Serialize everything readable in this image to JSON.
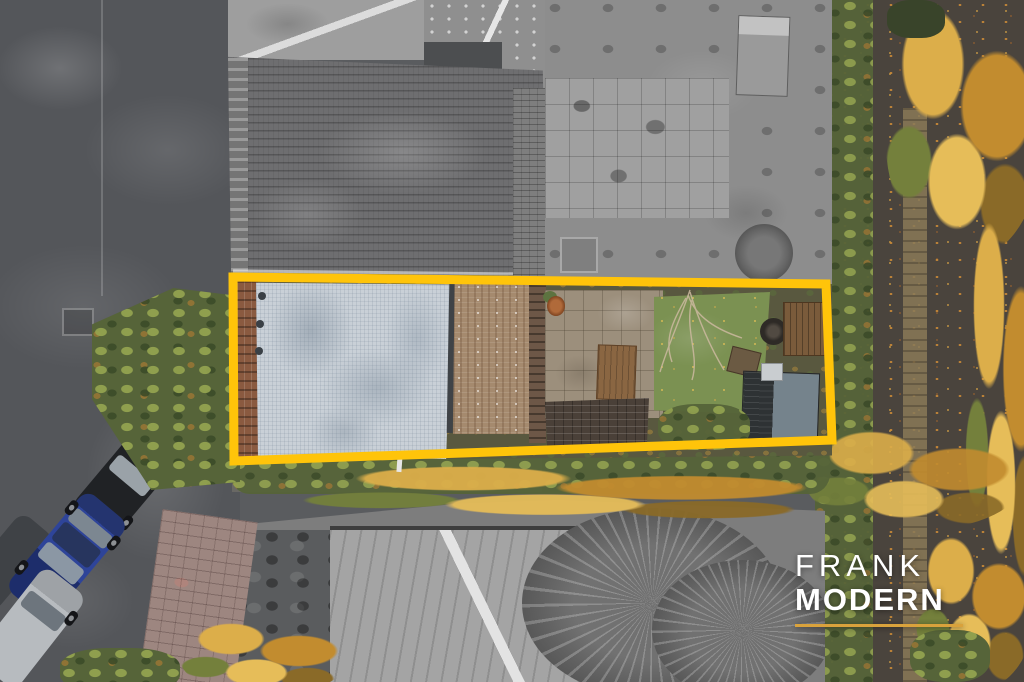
{
  "watermark": {
    "line1": "FRANK",
    "line2": "MODERN",
    "text_color": "#ffffff",
    "underline_color": "#d9a23c"
  },
  "property_highlight": {
    "color": "#ffc40a",
    "points": "233,277 826,284 832,440 234,461",
    "stroke_width": "9"
  }
}
